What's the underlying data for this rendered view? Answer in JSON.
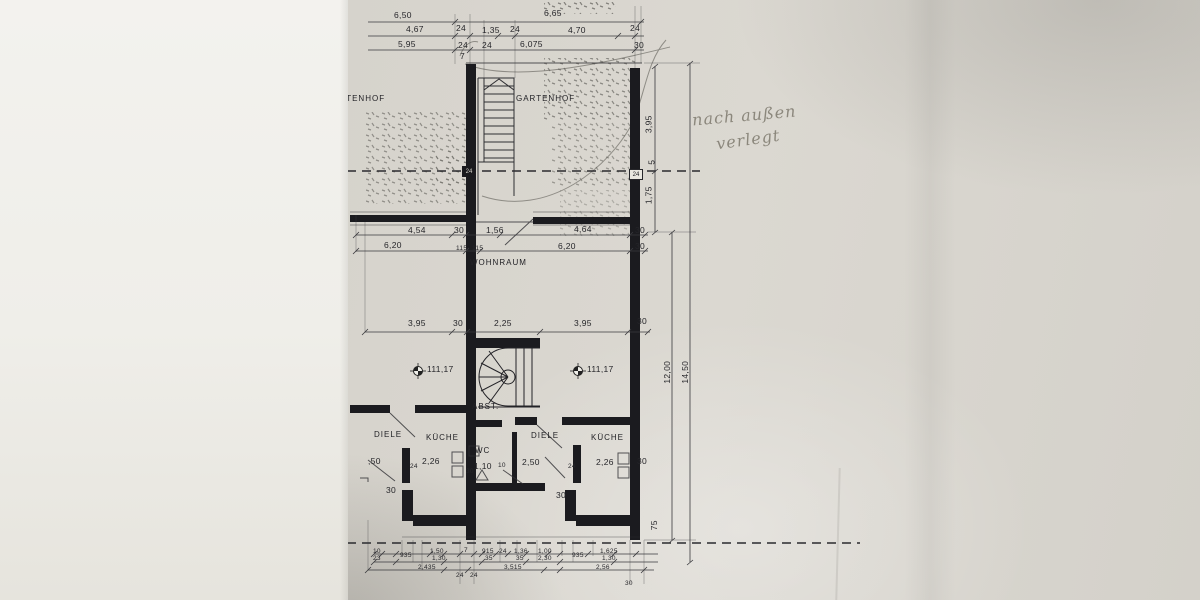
{
  "document": {
    "kind": "scanned architectural floor plan",
    "language": "de"
  },
  "note": {
    "line1": "nach außen",
    "line2": "verlegt"
  },
  "rooms": {
    "gartenhof_left": "GARTENHOF",
    "gartenhof_right": "GARTENHOF",
    "wohnraum": "WOHNRAUM",
    "diele_left": "DIELE",
    "kueche_left": "KÜCHE",
    "abstellraum": "ABST.",
    "wc": "WC",
    "diele_right": "DIELE",
    "kueche_right": "KÜCHE"
  },
  "levels": {
    "left": "111,17",
    "right": "111,17"
  },
  "dims": {
    "top1": [
      "6,50",
      "6,65"
    ],
    "top2": [
      "4,67",
      "24",
      "1,35",
      "24",
      "4,70",
      "24"
    ],
    "top3": [
      "5,95",
      "24",
      "24",
      "6,075",
      "30"
    ],
    "stair": {
      "steps": "7",
      "tag_left": "24",
      "tag_right": "24"
    },
    "terrace_a": [
      "4,54",
      "30",
      "1,56",
      "4,64",
      "30"
    ],
    "terrace_b": [
      "6,20",
      "115",
      "115",
      "6,20",
      "30"
    ],
    "mid": [
      "3,95",
      "30",
      "2,25",
      "3,95",
      "30"
    ],
    "left_unit": [
      ",50",
      "2,26",
      "24",
      "30"
    ],
    "wc_area": [
      "1,10",
      "30",
      "10"
    ],
    "right_unit": [
      "2,50",
      "2,26",
      "24",
      "30",
      "30"
    ],
    "bottom_a": [
      "10",
      "23",
      "935",
      "1,50",
      "1,30",
      "2,435",
      "7"
    ],
    "bottom_b": [
      "915",
      "35",
      "24",
      "1,36",
      "35",
      "3,515",
      "1,00",
      "2,30"
    ],
    "bottom_c": [
      "935",
      "1,625",
      "1,30",
      "2,56",
      "24",
      "24",
      "30"
    ],
    "right_col": [
      "3,95",
      "5",
      "1,75",
      "12,00",
      "14,50",
      "75"
    ]
  },
  "colors": {
    "ink": "#1b1b1f",
    "paper": "#d8d5ce",
    "pencil": "#8b877c"
  }
}
